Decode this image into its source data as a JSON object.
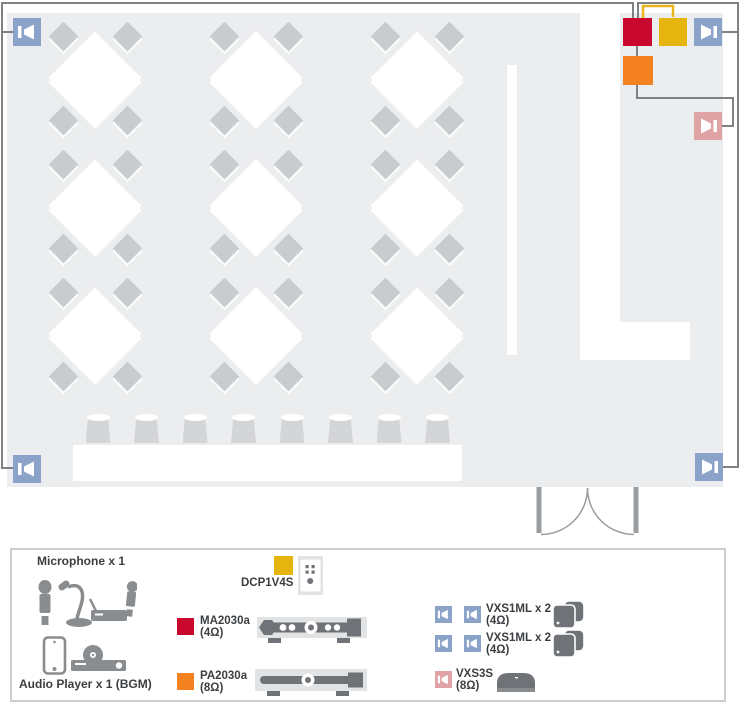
{
  "colors": {
    "floor": "#ecedef",
    "wire_gray": "#7f8285",
    "wire_yellow": "#e9b41c",
    "red": "#c9082e",
    "yellow": "#e6b40f",
    "orange": "#f58220",
    "blue_speaker": "#8ba3c9",
    "pink_speaker": "#e0a3a5",
    "device_dark": "#6f7276",
    "icon_gray": "#8a8d90",
    "device_bg": "#e2e3e5",
    "chair": "#c9ccce",
    "stool": "#d3d5d7",
    "door": "#9a9da0",
    "panel_border": "#cbcdcf",
    "text": "#3b3e41"
  },
  "floorplan": {
    "tables": {
      "cols_x": [
        95,
        256,
        417
      ],
      "rows_y": [
        78,
        206,
        334
      ],
      "chair_offset_x": 32,
      "chair_offset_y": 42
    },
    "stools": {
      "count": 8,
      "start_x": 98,
      "spacing": 48.5,
      "top_y": 415
    }
  },
  "diagram": {
    "microphone_label": "Microphone x 1",
    "audio_player_label": "Audio Player x 1 (BGM)",
    "dcp": {
      "label": "DCP1V4S"
    },
    "ma": {
      "label": "MA2030a",
      "impedance": "(4Ω)"
    },
    "pa": {
      "label": "PA2030a",
      "impedance": "(8Ω)"
    },
    "vxs1ml_rows": [
      {
        "label": "VXS1ML x 2",
        "impedance": "(4Ω)"
      },
      {
        "label": "VXS1ML x 2",
        "impedance": "(4Ω)"
      }
    ],
    "vxs3s": {
      "label": "VXS3S",
      "impedance": "(8Ω)"
    }
  }
}
